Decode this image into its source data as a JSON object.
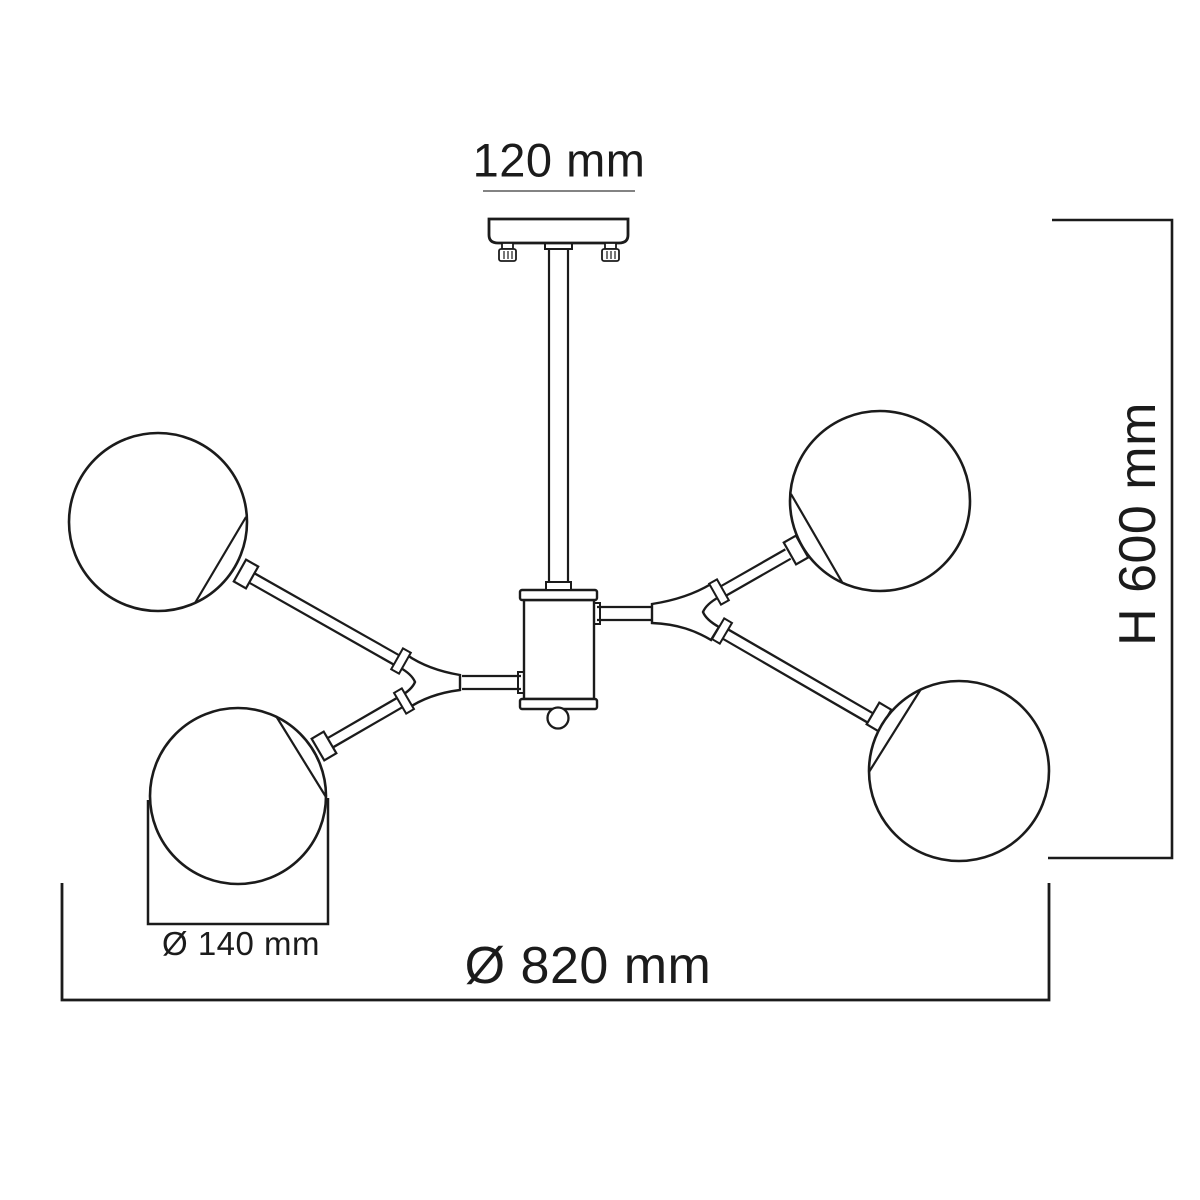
{
  "background": "#ffffff",
  "ink": "#1b1b1b",
  "labels": {
    "canopy_width": "120 mm",
    "height": "H 600 mm",
    "overall_diameter": "Ø 820 mm",
    "shade_diameter": "Ø 140 mm"
  },
  "figure": {
    "globe_count": 4
  }
}
